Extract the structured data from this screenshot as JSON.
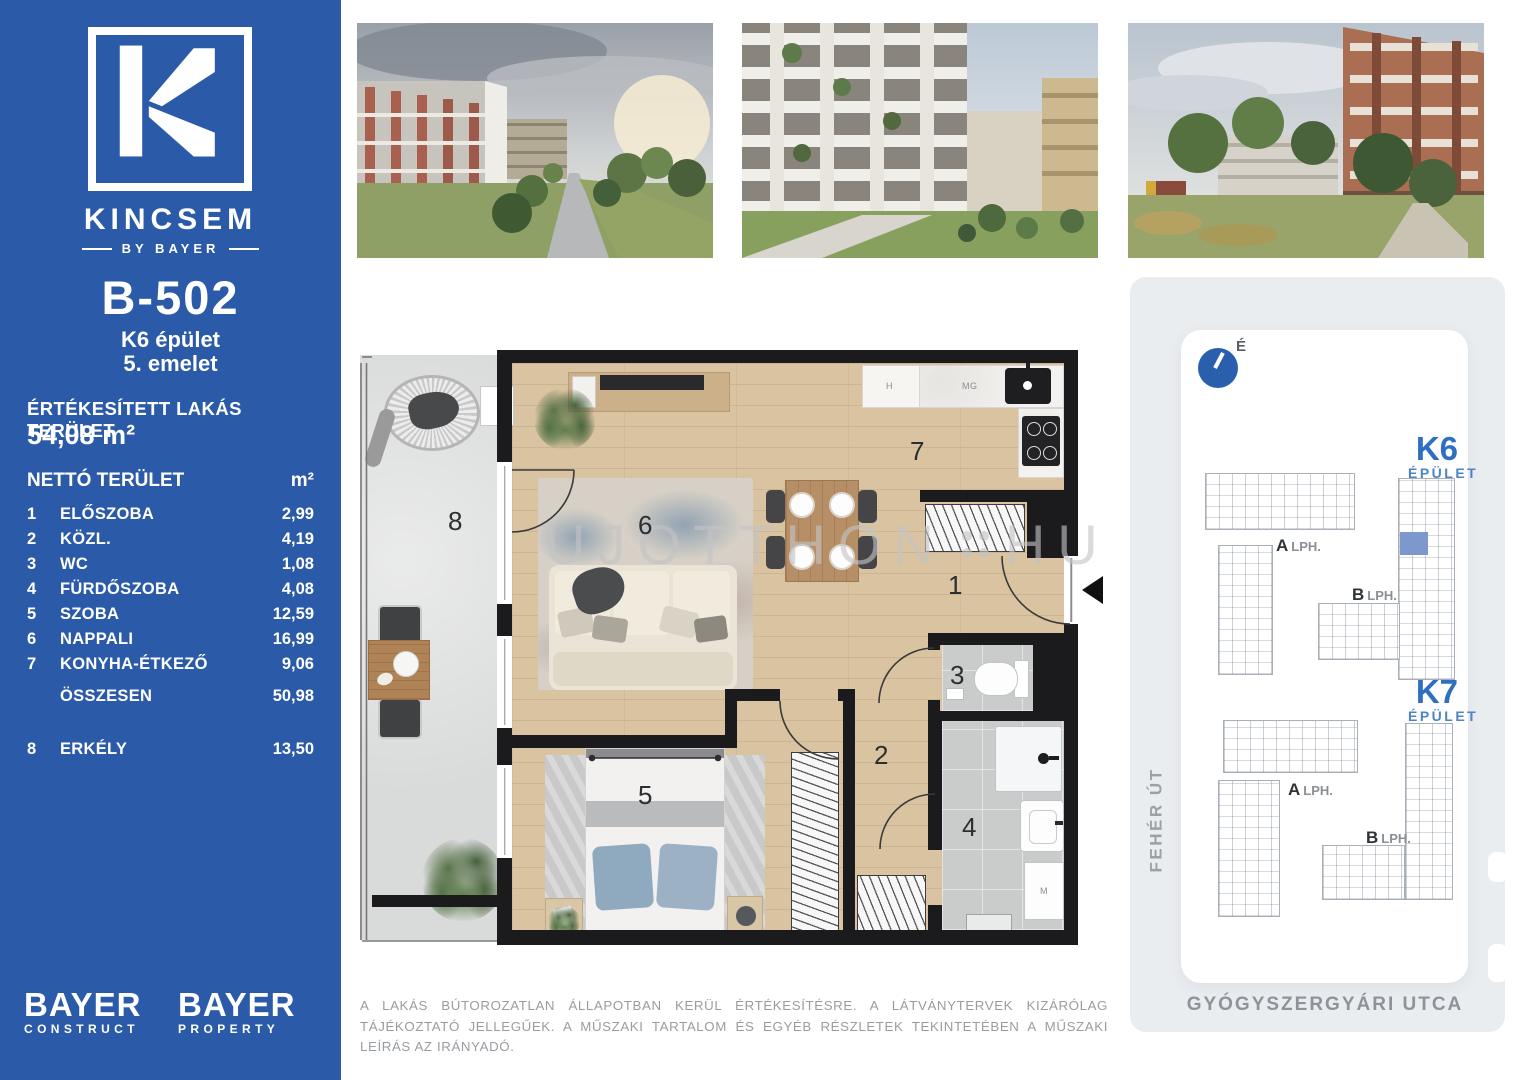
{
  "sidebar": {
    "brand": {
      "name": "KINCSEM",
      "byline": "BY BAYER"
    },
    "unit": {
      "code": "B-502",
      "building": "K6 épület",
      "floor": "5. emelet"
    },
    "sold_area": {
      "label": "ÉRTÉKESÍTETT LAKÁS TERÜLET",
      "value": "54,08 m²"
    },
    "net_table": {
      "title": "NETTÓ TERÜLET",
      "unit_header": "m²",
      "rows": [
        {
          "idx": "1",
          "name": "ELŐSZOBA",
          "value": "2,99"
        },
        {
          "idx": "2",
          "name": "KÖZL.",
          "value": "4,19"
        },
        {
          "idx": "3",
          "name": "WC",
          "value": "1,08"
        },
        {
          "idx": "4",
          "name": "FÜRDŐSZOBA",
          "value": "4,08"
        },
        {
          "idx": "5",
          "name": "SZOBA",
          "value": "12,59"
        },
        {
          "idx": "6",
          "name": "NAPPALI",
          "value": "16,99"
        },
        {
          "idx": "7",
          "name": "KONYHA-ÉTKEZŐ",
          "value": "9,06"
        }
      ],
      "total": {
        "name": "ÖSSZESEN",
        "value": "50,98"
      },
      "balcony": {
        "idx": "8",
        "name": "ERKÉLY",
        "value": "13,50"
      }
    },
    "footer_logos": [
      {
        "top": "BAYER",
        "bottom": "CONSTRUCT"
      },
      {
        "top": "BAYER",
        "bottom": "PROPERTY"
      }
    ]
  },
  "floorplan": {
    "rooms": [
      "1",
      "2",
      "3",
      "4",
      "5",
      "6",
      "7",
      "8"
    ],
    "appliance_labels": {
      "h": "H",
      "mg": "MG",
      "m": "M"
    },
    "watermark": {
      "left": "ÚJOTTHON",
      "right": "HU"
    }
  },
  "sitemap": {
    "north_label": "É",
    "k6": {
      "name": "K6",
      "type": "ÉPÜLET",
      "a": "A",
      "a_suffix": "LPH.",
      "b": "B",
      "b_suffix": "LPH."
    },
    "k7": {
      "name": "K7",
      "type": "ÉPÜLET",
      "a": "A",
      "a_suffix": "LPH.",
      "b": "B",
      "b_suffix": "LPH."
    },
    "streets": {
      "left": "FEHÉR ÚT",
      "bottom": "GYÓGYSZERGYÁRI UTCA"
    }
  },
  "disclaimer": "A LAKÁS BÚTOROZATLAN ÁLLAPOTBAN KERÜL ÉRTÉKESÍTÉSRE. A LÁTVÁNYTERVEK KIZÁRÓLAG TÁJÉKOZTATÓ JELLEGŰEK. A MŰSZAKI TARTALOM ÉS EGYÉB RÉSZLETEK TEKINTETÉBEN A MŰSZAKI LEÍRÁS AZ IRÁNYADÓ.",
  "colors": {
    "brand_blue": "#2b5ba8",
    "accent_blue": "#2e6fc2",
    "highlight_unit": "#7d98cd"
  }
}
